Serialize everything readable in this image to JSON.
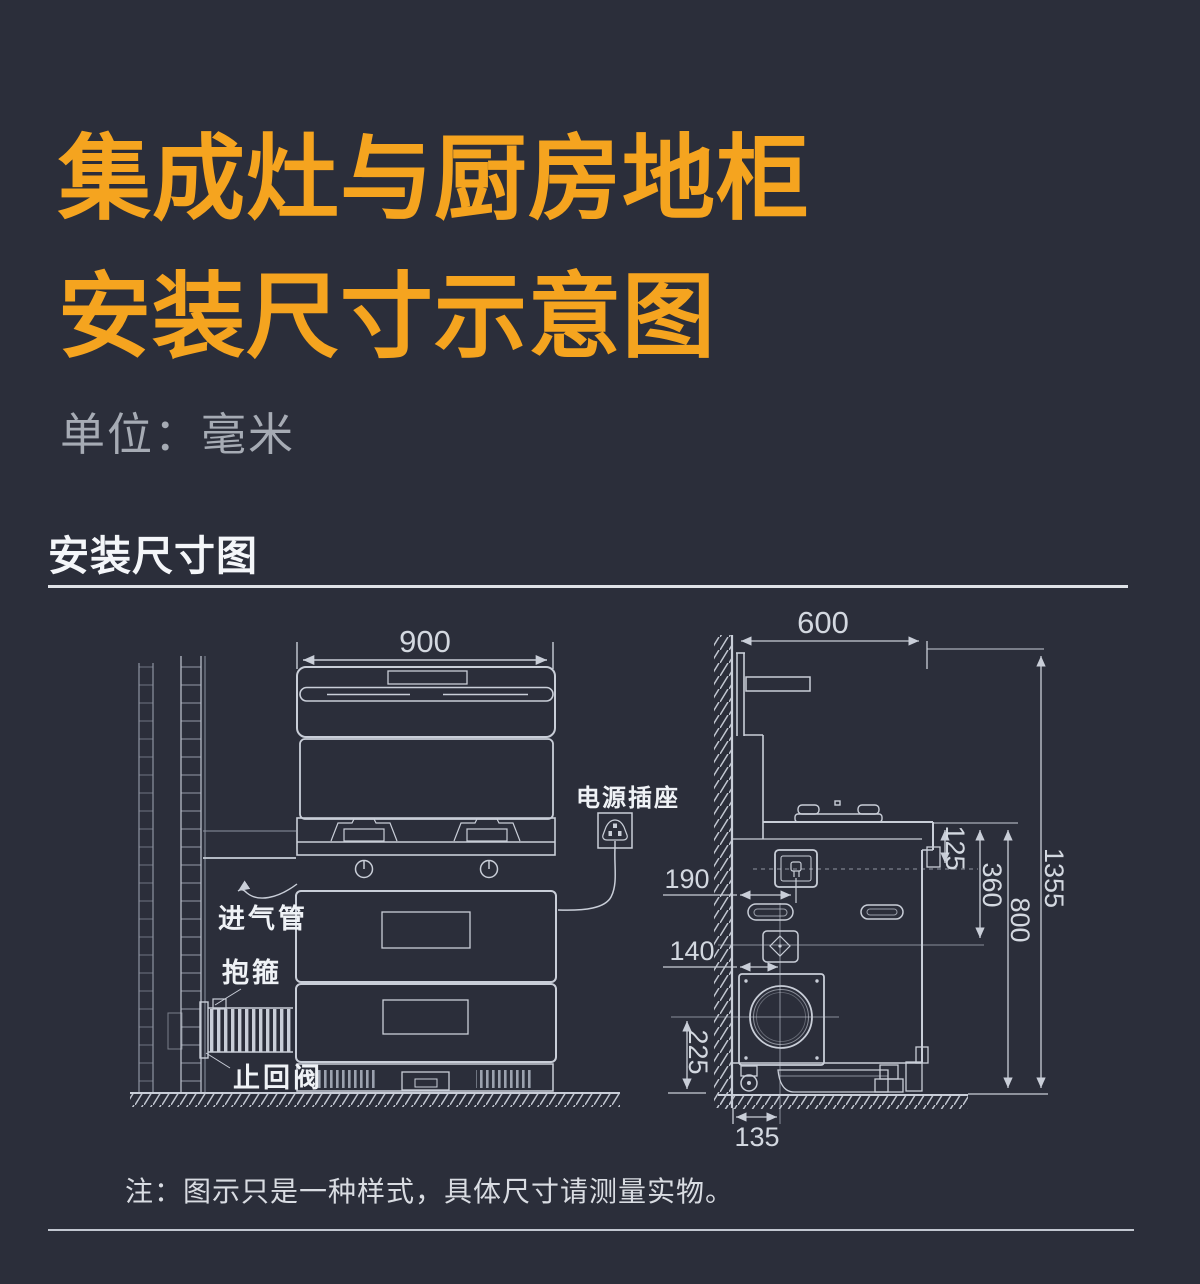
{
  "page": {
    "title_line1": "集成灶与厨房地柜",
    "title_line2": "安装尺寸示意图",
    "unit_label": "单位：毫米",
    "section_heading": "安装尺寸图",
    "note": "注：图示只是一种样式，具体尺寸请测量实物。"
  },
  "diagram": {
    "colors": {
      "background": "#2B2E3A",
      "title_orange": "#F5A41F",
      "line": "#C9CED8",
      "dim_text": "#D3D8E0"
    },
    "front_view": {
      "width_mm": "900",
      "labels": {
        "power_socket": "电源插座",
        "gas_inlet_pipe": "进气管",
        "clamp": "抱箍",
        "check_valve": "止回阀"
      }
    },
    "side_view": {
      "dims": {
        "top_depth": "600",
        "wall_to_socket": "190",
        "wall_to_valve": "140",
        "counter_to_socket": "125",
        "counter_to_valve": "360",
        "counter_height": "800",
        "total_height": "1355",
        "outlet_center_height": "225",
        "wall_to_outlet_center": "135"
      }
    }
  }
}
